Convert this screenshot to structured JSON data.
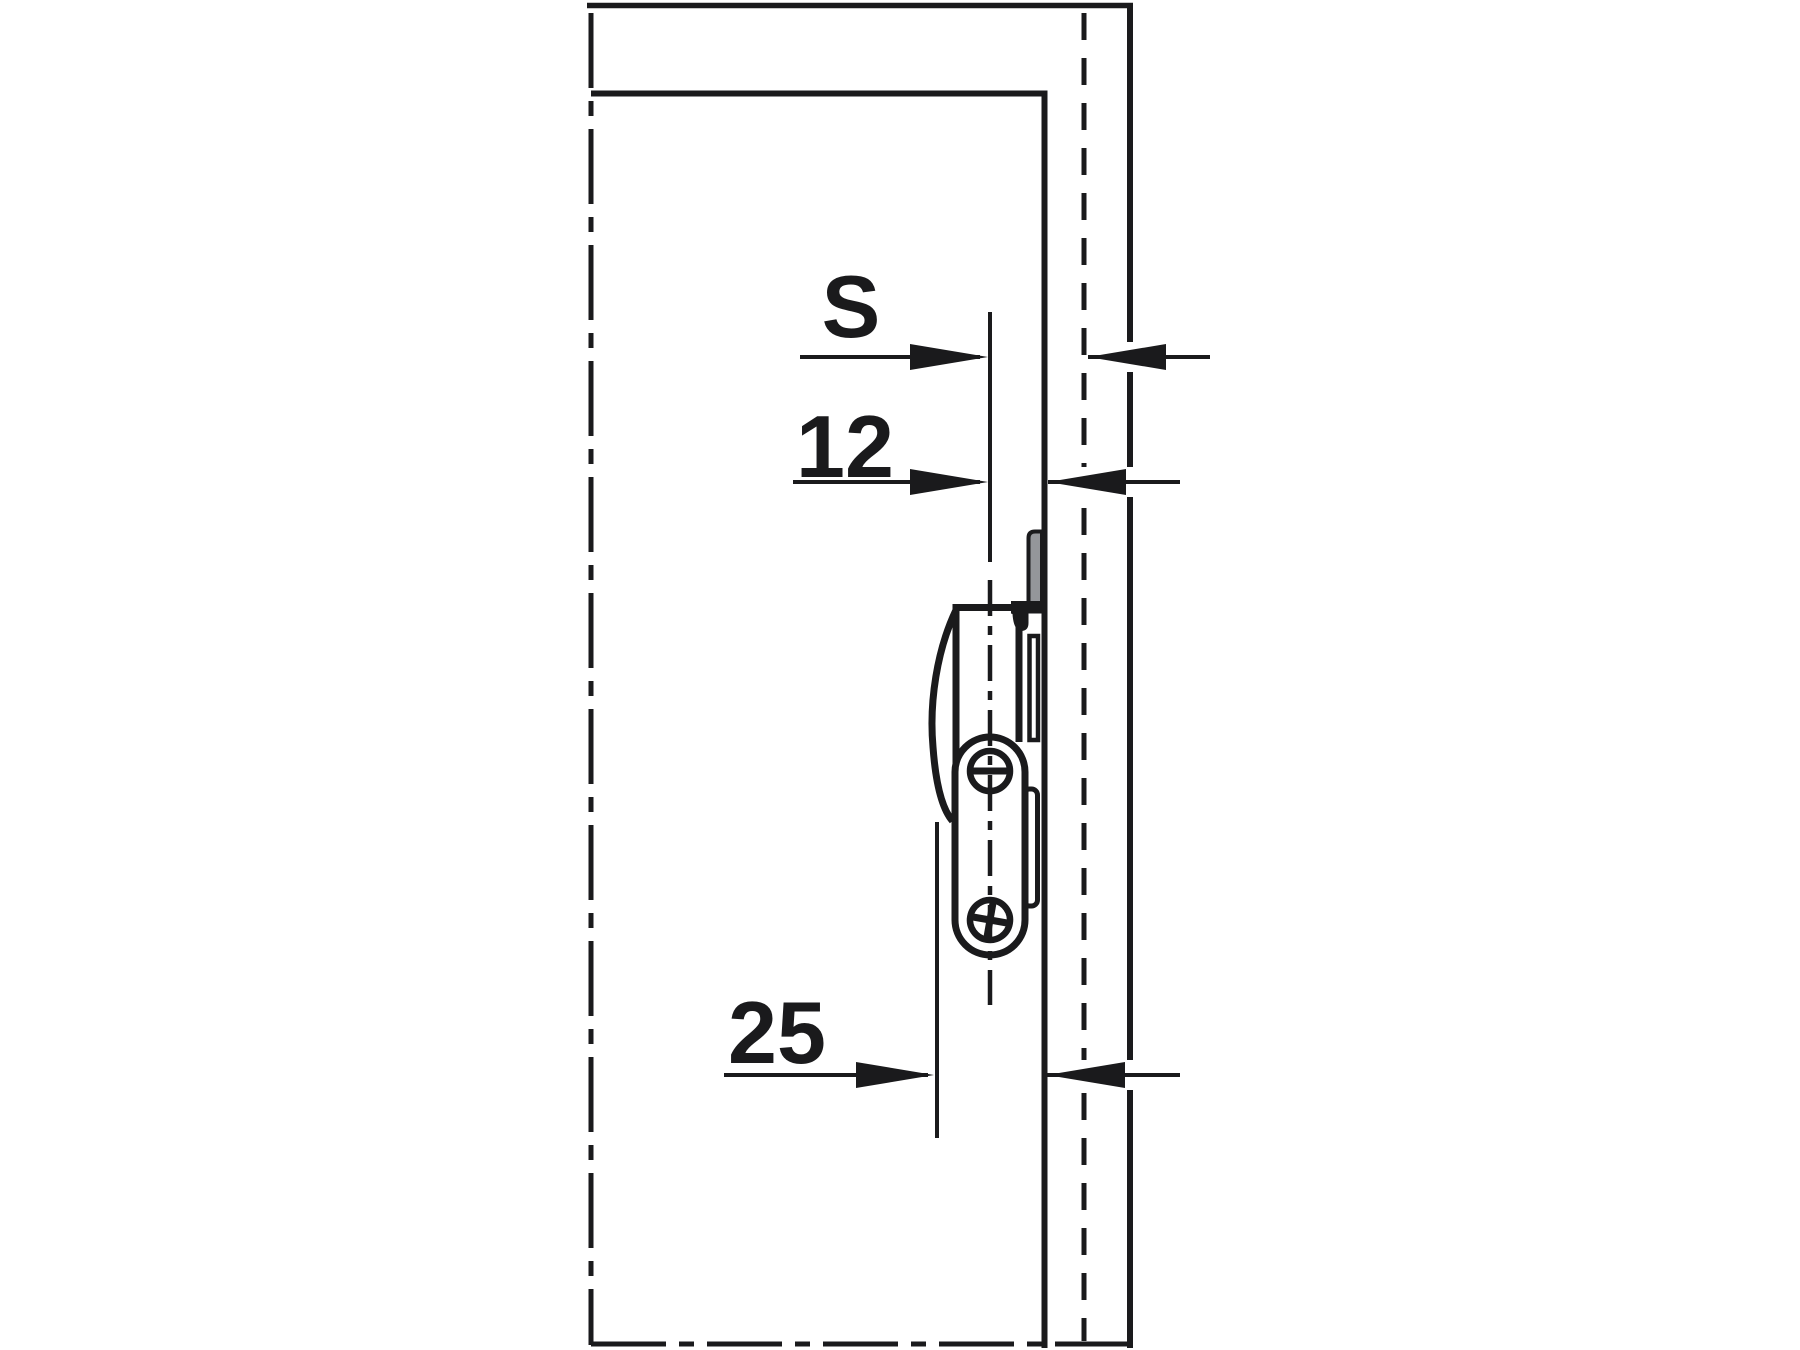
{
  "diagram": {
    "type": "technical-installation-drawing",
    "description_visible_content": "Sectional line drawing of a cabinet corner with a catch fitting mounted near the side panel, annotated with three horizontal dimension arrows",
    "dimensions": [
      {
        "id": "s",
        "label": "S"
      },
      {
        "id": "d12",
        "label": "12"
      },
      {
        "id": "d25",
        "label": "25"
      }
    ],
    "colors": {
      "background": "#ffffff",
      "line": "#1a1a1c",
      "strike_plate_gray": "#94969a"
    },
    "line_styles": {
      "panel_edge": "solid",
      "panel_mid_line": "dashed",
      "center_axis": "dash-dot"
    }
  }
}
